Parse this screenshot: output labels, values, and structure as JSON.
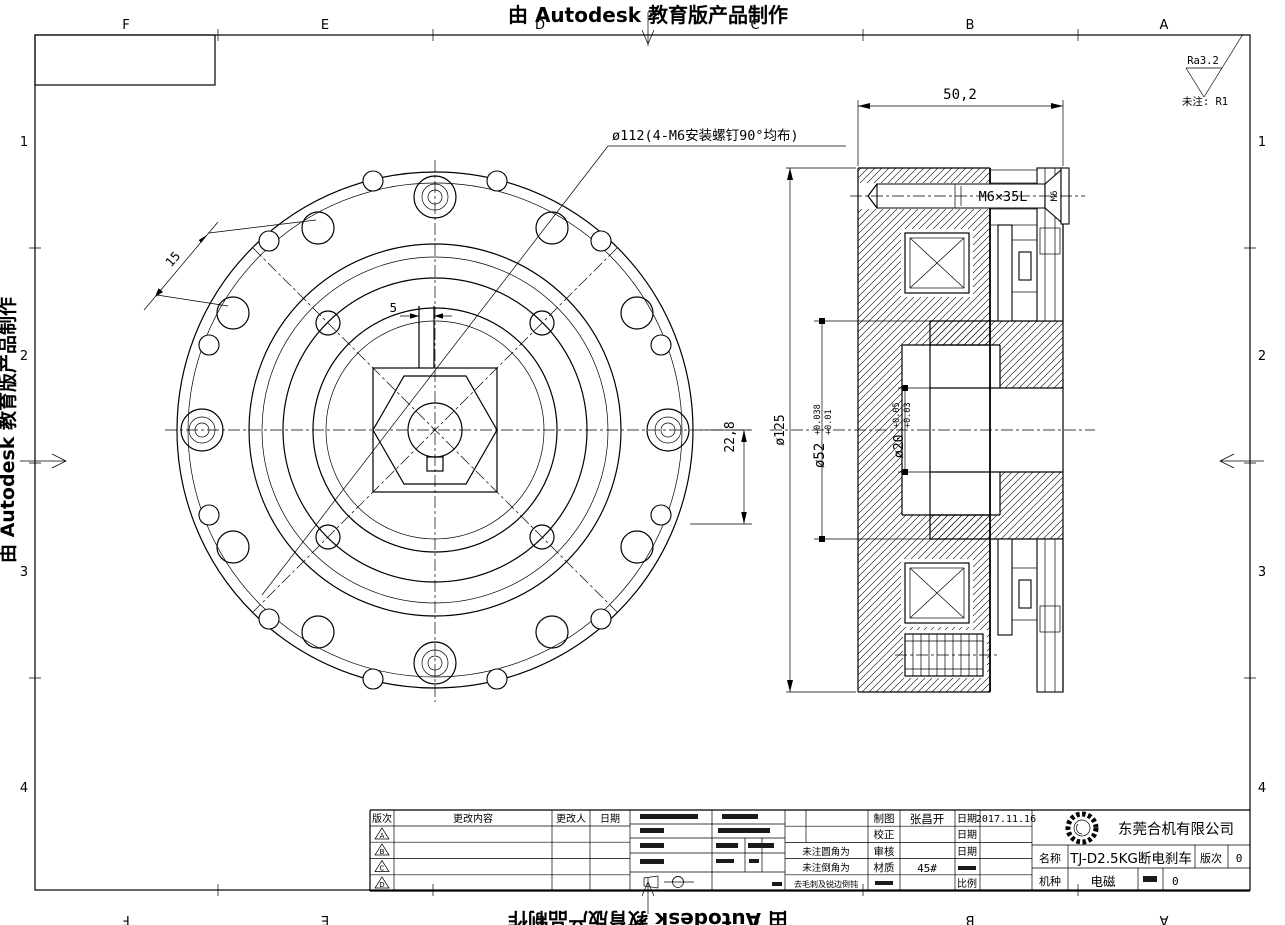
{
  "watermark": {
    "text": "由 Autodesk 教育版产品制作"
  },
  "notes": {
    "roughness": "Ra3.2",
    "unnoted": "未注: R1"
  },
  "front_view": {
    "bolt_circle_label": "ø112(4-M6安装螺钉90°均布)",
    "keyway_width": "5",
    "hole_pitch": "15",
    "keyway_depth": "22,8"
  },
  "section_view": {
    "overall_width": "50,2",
    "outer_dia": "ø125",
    "hub_dia": "ø52",
    "hub_tol_hi": "+0.038",
    "hub_tol_lo": "+0.01",
    "bore_dia": "ø20",
    "bore_tol_hi": "+0.05",
    "bore_tol_lo": "+0.03",
    "bolt": "M6×35L",
    "bolt_thread": "M6"
  },
  "frame": {
    "cols": [
      "F",
      "E",
      "D",
      "C",
      "B",
      "A"
    ],
    "rows": [
      "1",
      "2",
      "3",
      "4"
    ]
  },
  "revisions": {
    "headers": [
      "版次",
      "更改内容",
      "更改人",
      "日期"
    ],
    "marks": [
      "A",
      "B",
      "C",
      "D"
    ]
  },
  "title_block": {
    "company": "东莞合机有限公司",
    "drawn_label": "制图",
    "drawn_by": "张昌开",
    "date_label": "日期",
    "date_value": "2017.11.16",
    "proof_label": "校正",
    "audit_label": "审核",
    "material_label": "材质",
    "material_value": "45#",
    "scale_label": "比例",
    "fillet_note": "未注圆角为",
    "chamfer_note": "未注倒角为",
    "deburr_note": "去毛刺及锐边倒钝",
    "name_label": "名称",
    "name_value": "TJ-D2.5KG断电刹车",
    "version_label": "版次",
    "version_value": "0",
    "model_label": "机种",
    "model_value": "电磁",
    "sheet_value": "0"
  }
}
